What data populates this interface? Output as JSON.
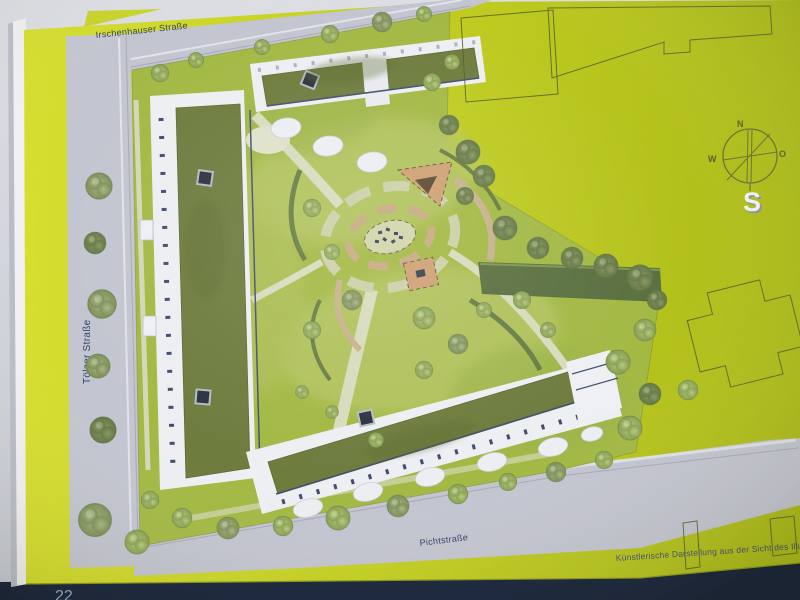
{
  "page": {
    "number": "22",
    "caption": "Künstlerische Darstellung aus der Sicht des Illus"
  },
  "streets": {
    "top": "Irschenhauser Straße",
    "left": "Tölzer Straße",
    "bottom": "Pichtstraße"
  },
  "compass": {
    "north": "N",
    "west": "W",
    "east": "O",
    "south": "S"
  },
  "palette": {
    "page_yellow": "#c4d021",
    "street_gray": "#c3c5d0",
    "roof_green": "#6e7c3e",
    "lawn_green": "#a3b944",
    "building_white": "#edeff3",
    "facade_blue": "#3f4d70",
    "play_tan": "#cfa173",
    "desk_navy": "#17223a",
    "label_blue": "#33406a"
  }
}
